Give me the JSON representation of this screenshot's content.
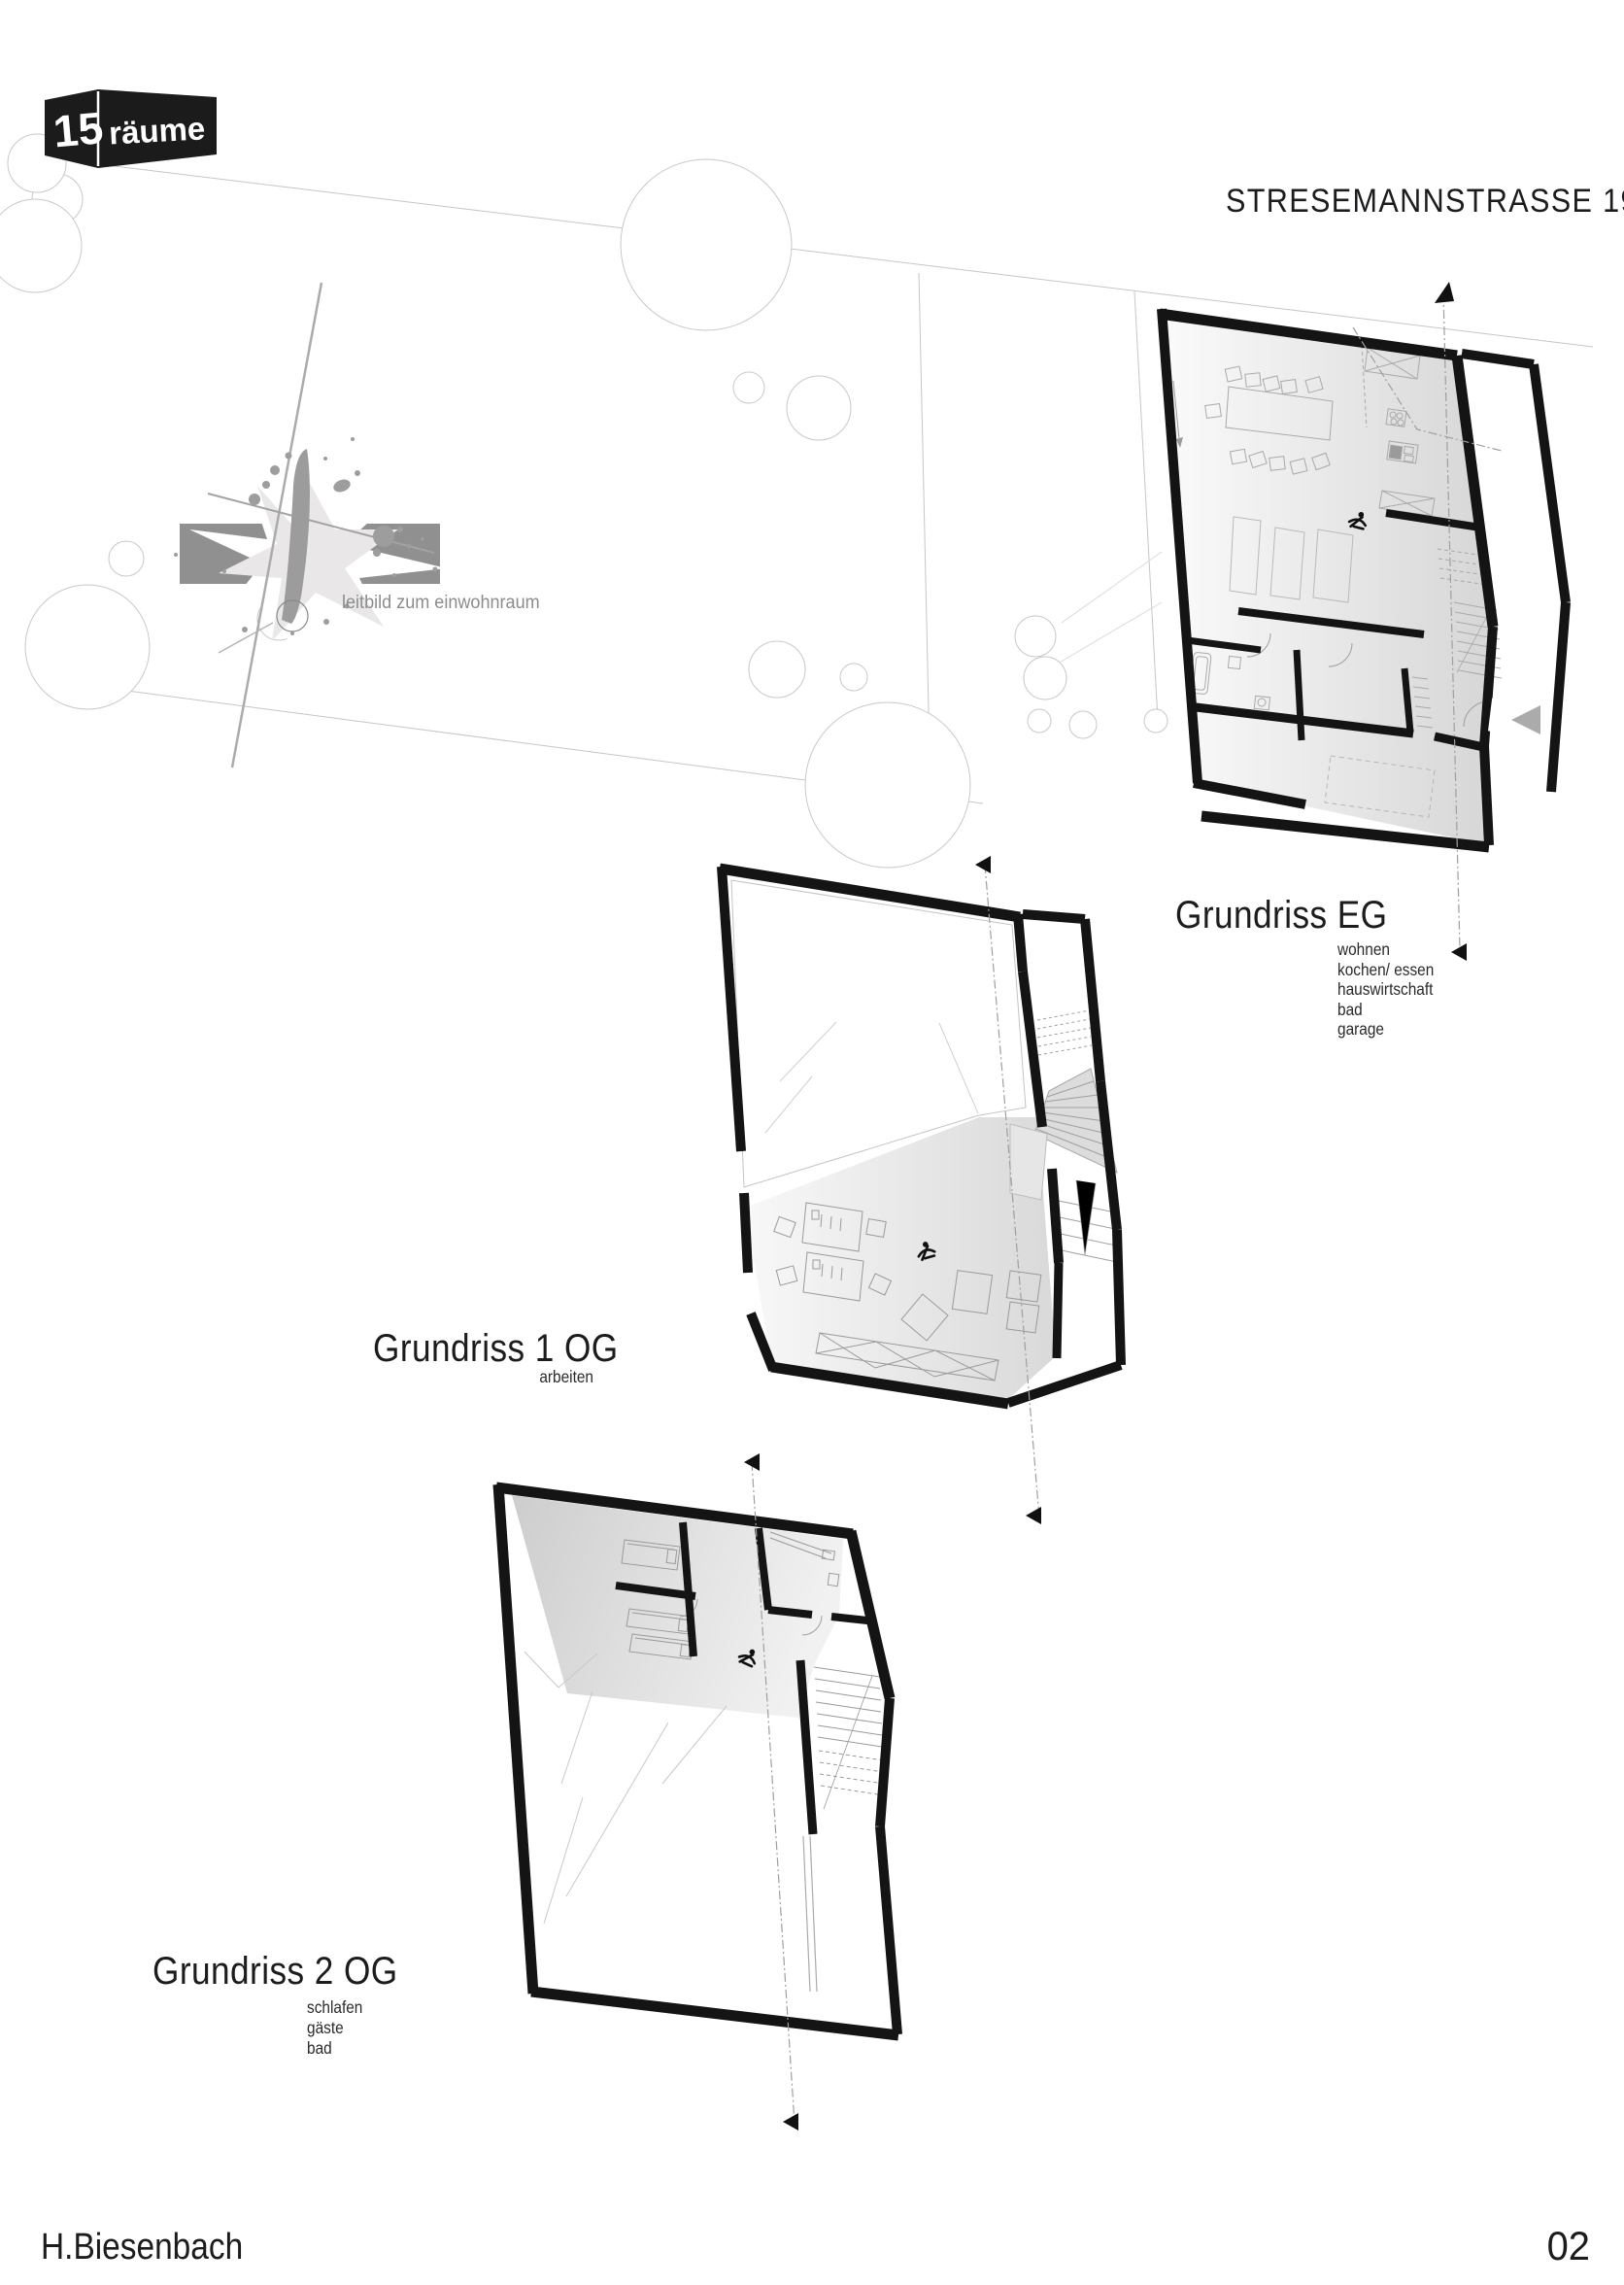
{
  "logo": {
    "number": "15",
    "name": "räume"
  },
  "title": "STRESEMANNSTRASSE 191",
  "sketch": {
    "caption": "leitbild zum einwohnraum"
  },
  "plans": {
    "eg": {
      "label": "Grundriss EG",
      "rooms": [
        "wohnen",
        "kochen/ essen",
        "hauswirtschaft",
        "bad",
        "garage"
      ]
    },
    "og1": {
      "label": "Grundriss 1 OG",
      "rooms": [
        "arbeiten"
      ]
    },
    "og2": {
      "label": "Grundriss 2 OG",
      "rooms": [
        "schlafen",
        "gäste",
        "bad"
      ]
    }
  },
  "footer": {
    "author": "H.Biesenbach",
    "page": "02"
  },
  "colors": {
    "ink": "#1c1c1e",
    "wall": "#141414",
    "muted_text": "#8c8c8c",
    "site_line": "#c6c6c6",
    "sketch_gray": "#909090",
    "marker_gray": "#ababab"
  }
}
